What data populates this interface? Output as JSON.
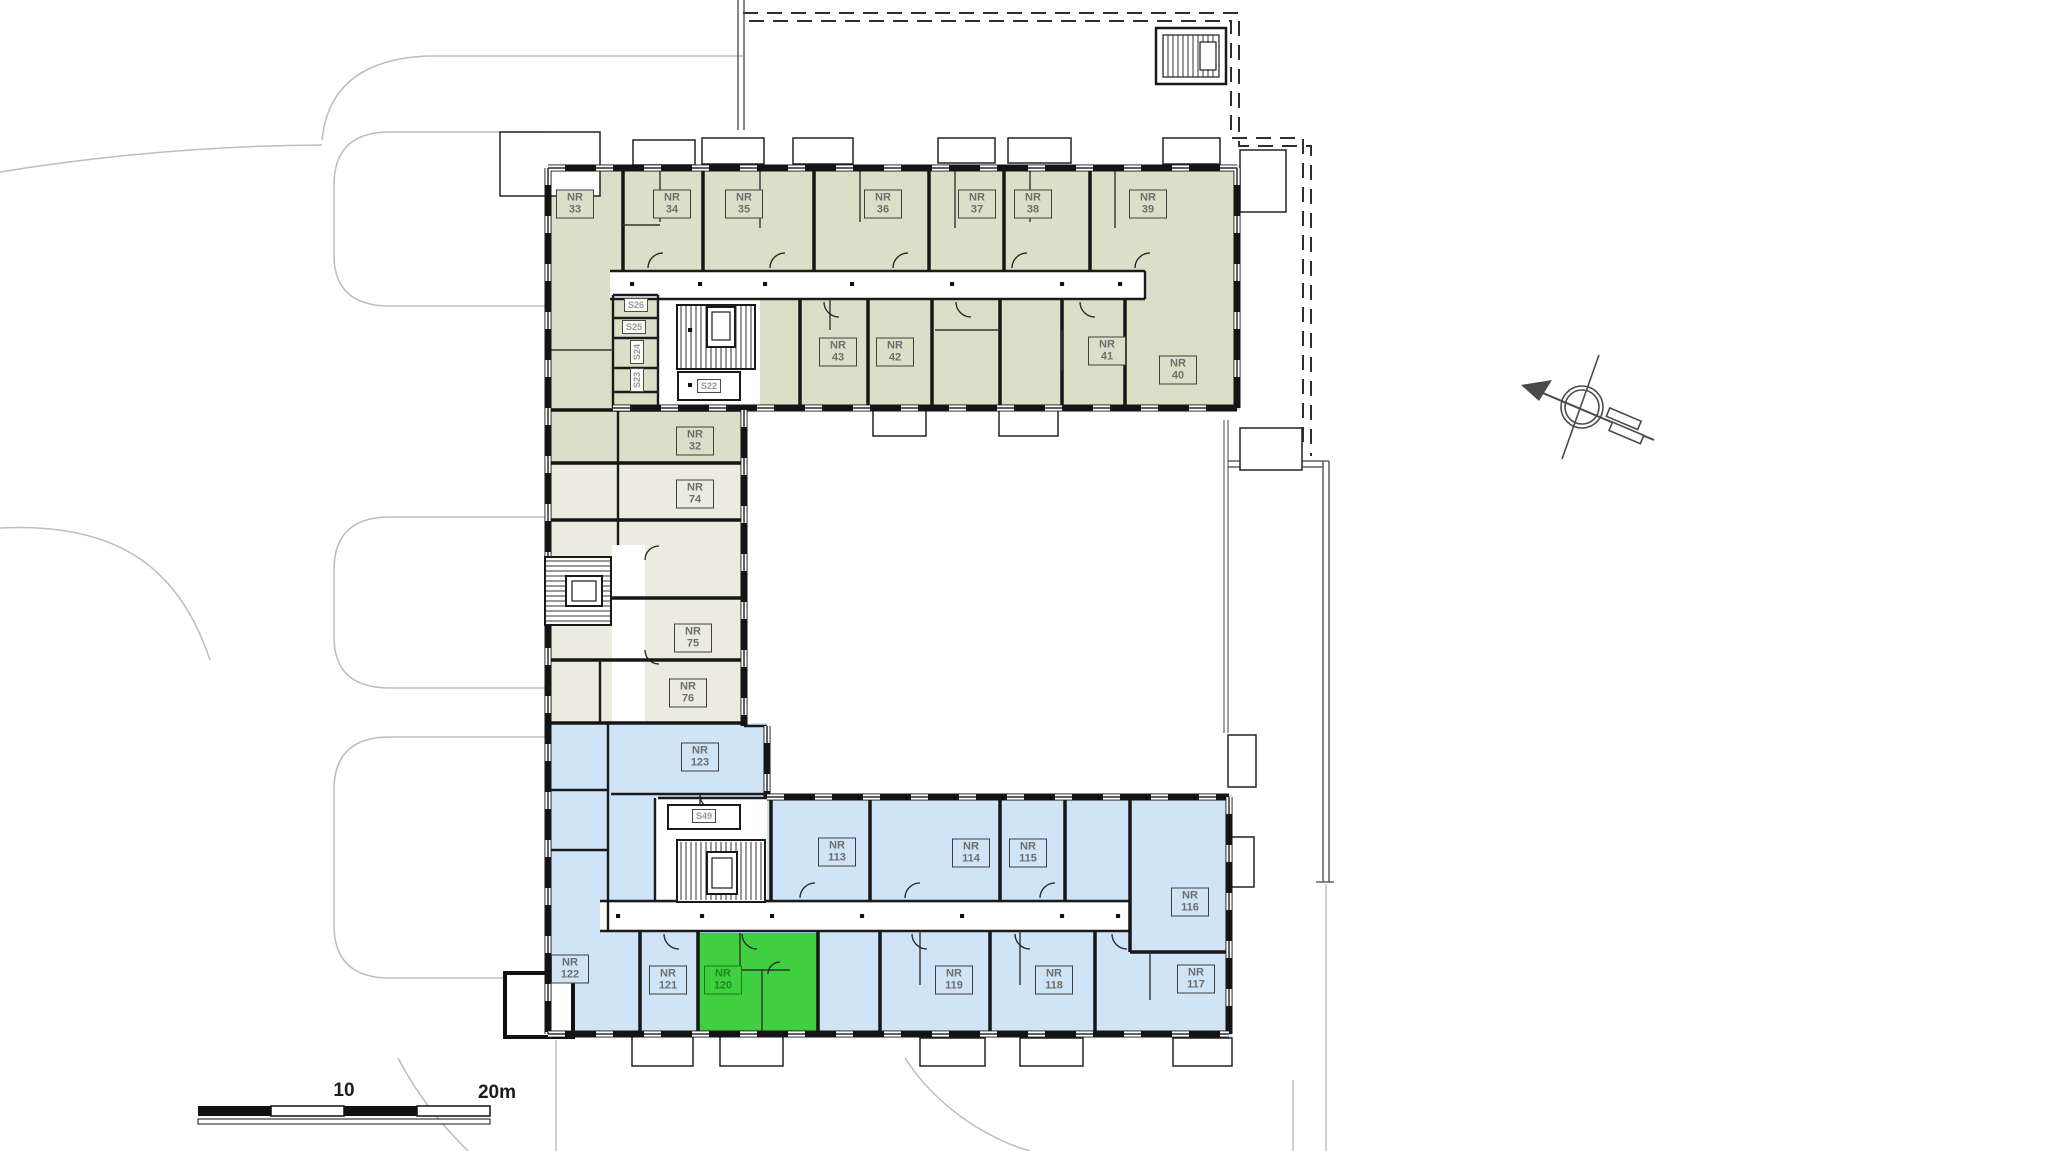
{
  "colors": {
    "wing_north_olive": "#dcdfc8",
    "wing_middle_cream": "#ebebdf",
    "wing_south_blue": "#cfe4f6",
    "highlight_green": "#40d03f",
    "wall_black": "#141414",
    "site_line_gray": "#bdbdbd"
  },
  "rooms": {
    "north_upper": [
      {
        "id": "NR 33",
        "label": "NR\n33"
      },
      {
        "id": "NR 34",
        "label": "NR\n34"
      },
      {
        "id": "NR 35",
        "label": "NR\n35"
      },
      {
        "id": "NR 36",
        "label": "NR\n36"
      },
      {
        "id": "NR 37",
        "label": "NR\n37"
      },
      {
        "id": "NR 38",
        "label": "NR\n38"
      },
      {
        "id": "NR 39",
        "label": "NR\n39"
      }
    ],
    "north_lower": [
      {
        "id": "NR 43",
        "label": "NR\n43"
      },
      {
        "id": "NR 42",
        "label": "NR\n42"
      },
      {
        "id": "NR 41",
        "label": "NR\n41"
      },
      {
        "id": "NR 40",
        "label": "NR\n40"
      }
    ],
    "north_storage": [
      {
        "id": "S26",
        "label": "S26"
      },
      {
        "id": "S25",
        "label": "S25"
      },
      {
        "id": "S24",
        "label": "S24"
      },
      {
        "id": "S23",
        "label": "S23"
      },
      {
        "id": "S22",
        "label": "S22"
      }
    ],
    "west_units": [
      {
        "id": "NR 32",
        "label": "NR\n32"
      },
      {
        "id": "NR 74",
        "label": "NR\n74"
      },
      {
        "id": "NR 75",
        "label": "NR\n75"
      },
      {
        "id": "NR 76",
        "label": "NR\n76"
      }
    ],
    "south_upper": [
      {
        "id": "NR 123",
        "label": "NR\n123"
      },
      {
        "id": "NR 113",
        "label": "NR\n113"
      },
      {
        "id": "NR 114",
        "label": "NR\n114"
      },
      {
        "id": "NR 115",
        "label": "NR\n115"
      },
      {
        "id": "NR 116",
        "label": "NR\n116"
      }
    ],
    "south_storage": [
      {
        "id": "S49",
        "label": "S49"
      }
    ],
    "south_lower": [
      {
        "id": "NR 122",
        "label": "NR\n122"
      },
      {
        "id": "NR 121",
        "label": "NR\n121"
      },
      {
        "id": "NR 120",
        "label": "NR\n120"
      },
      {
        "id": "NR 119",
        "label": "NR\n119"
      },
      {
        "id": "NR 118",
        "label": "NR\n118"
      },
      {
        "id": "NR 117",
        "label": "NR\n117"
      }
    ]
  },
  "highlighted_unit": "NR 120",
  "scale_bar": {
    "half_label": "10",
    "full_label": "20m"
  }
}
